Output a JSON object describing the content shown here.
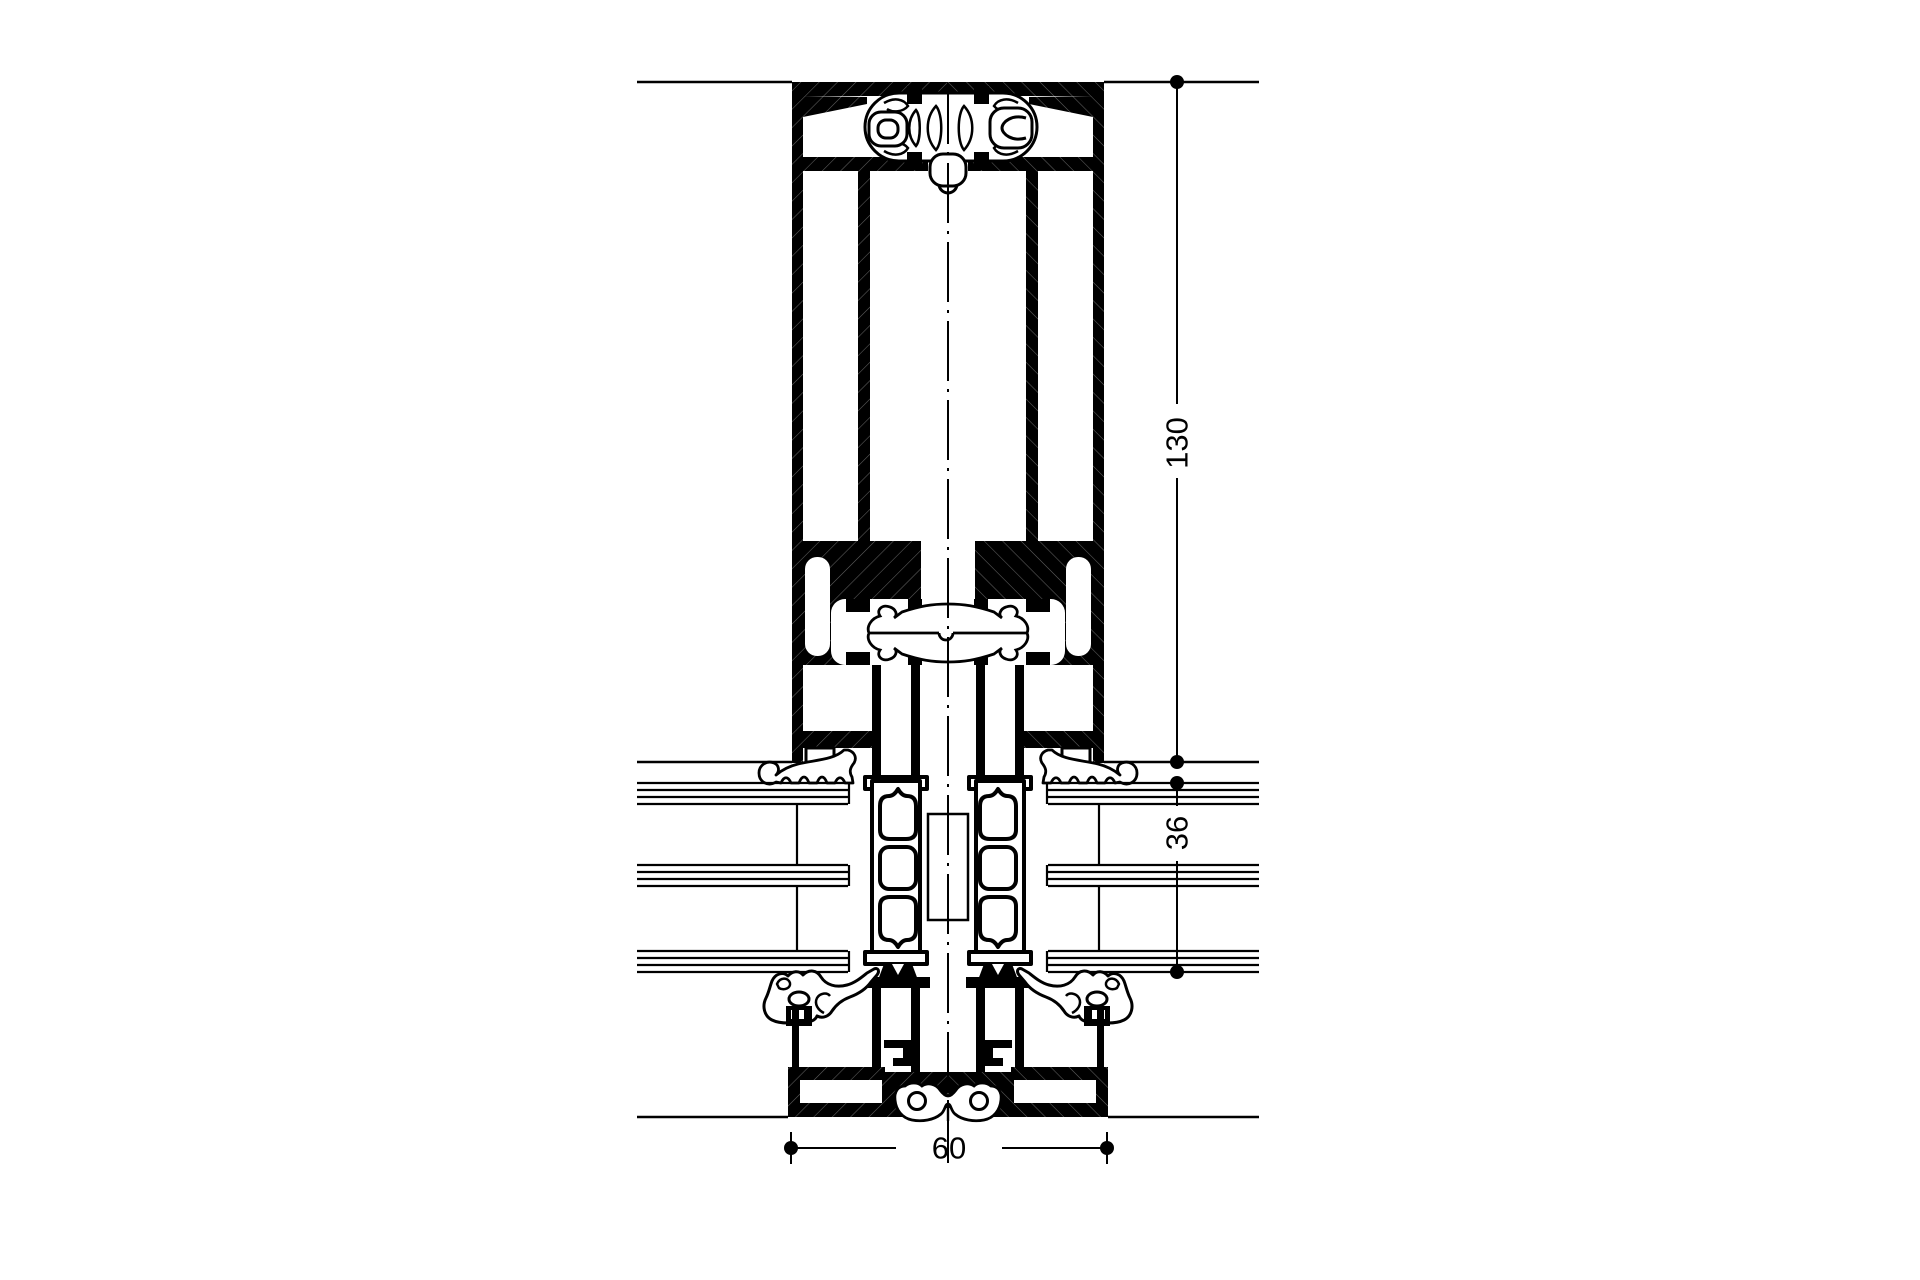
{
  "drawing": {
    "background_color": "#ffffff",
    "line_color": "#000000"
  },
  "dimensions": {
    "frame_depth": {
      "value": "130"
    },
    "infill_thickness": {
      "value": "36"
    },
    "profile_width": {
      "value": "60"
    }
  }
}
